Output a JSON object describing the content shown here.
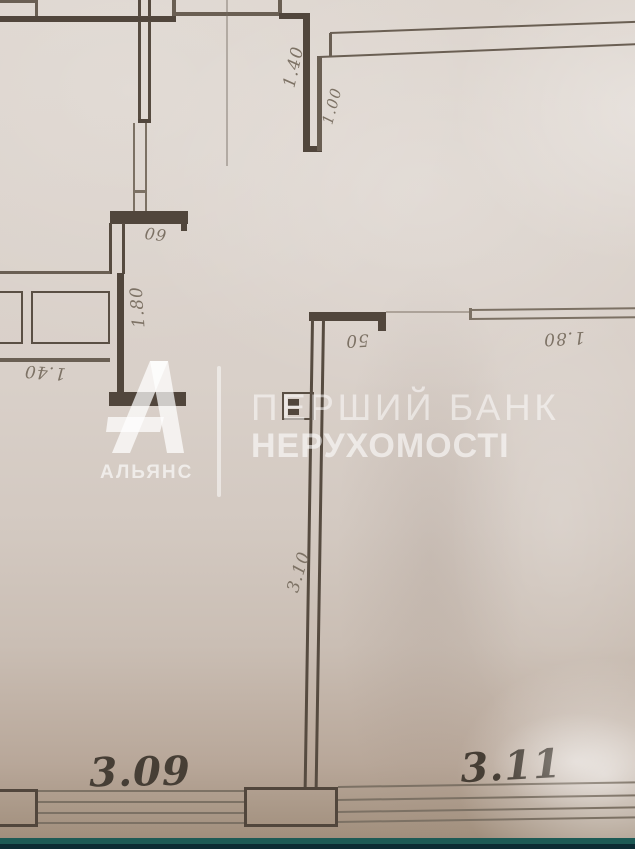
{
  "watermark": {
    "brand_letter": "А",
    "brand_name": "АЛЬЯНС",
    "title_line1": "ПЕРШИЙ БАНК",
    "title_line2": "НЕРУХОМОСТІ"
  },
  "floor_plan": {
    "dimension_labels": [
      {
        "id": "dim-1-40-top-wall",
        "text": "1.40"
      },
      {
        "id": "dim-1-00-top-wall",
        "text": "1.00"
      },
      {
        "id": "dim-60-closet",
        "text": "60"
      },
      {
        "id": "dim-1-80-corridor",
        "text": "1.80"
      },
      {
        "id": "dim-1-40-niche",
        "text": "1.40"
      },
      {
        "id": "dim-50-partition-stub",
        "text": "50"
      },
      {
        "id": "dim-1-80-opening",
        "text": "1.80"
      },
      {
        "id": "dim-3-10-dividing-wall",
        "text": "3.10"
      }
    ],
    "room_labels": [
      {
        "id": "room-3-09",
        "text": "3.09"
      },
      {
        "id": "room-3-11",
        "text": "3.11"
      }
    ]
  },
  "colors": {
    "paper": "#d8cfc8",
    "wall_ink": "#51463c",
    "pencil_ink": "#7d7265",
    "room_label_ink": "#463e35",
    "watermark_white": "#ffffff",
    "bottom_strip_teal": "#1d5a55",
    "bottom_strip_dark": "#0c2b33"
  }
}
